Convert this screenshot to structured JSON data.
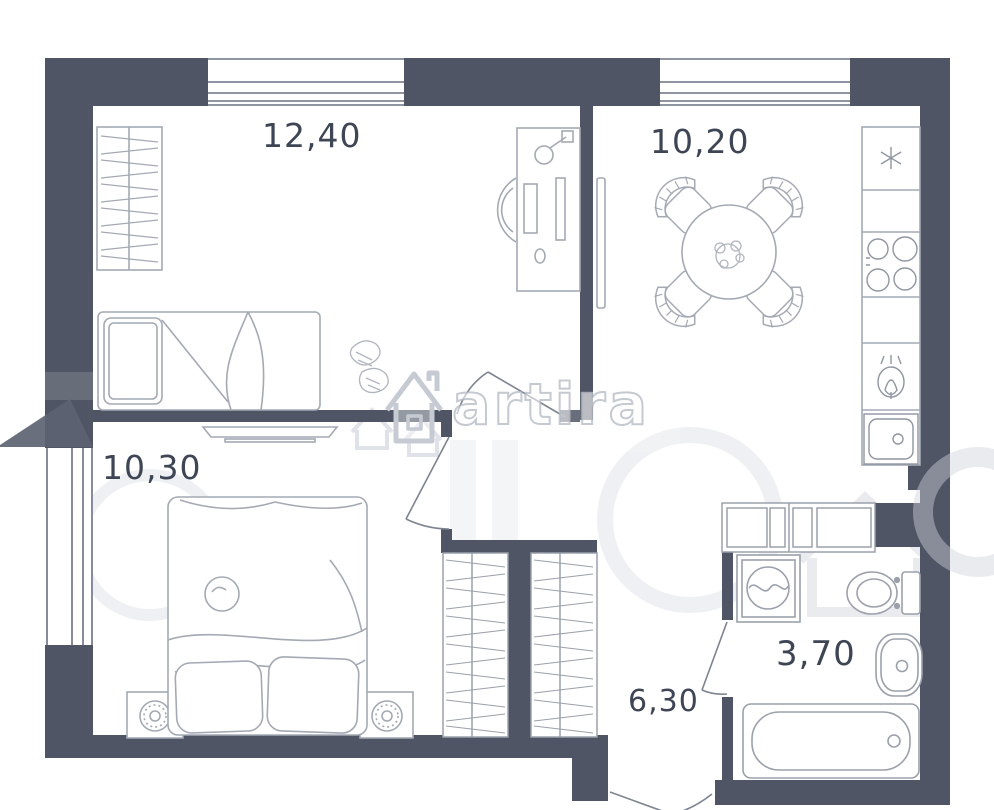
{
  "plan": {
    "type": "apartment-floor-plan",
    "rooms": [
      {
        "id": "bedroom-top",
        "name": "room with desk and single bed",
        "area_label": "12,40"
      },
      {
        "id": "kitchen",
        "name": "kitchen with dining table",
        "area_label": "10,20"
      },
      {
        "id": "bedroom-bottom",
        "name": "room with double bed",
        "area_label": "10,30"
      },
      {
        "id": "hallway",
        "name": "hallway with closets",
        "area_label": "6,30"
      },
      {
        "id": "bathroom",
        "name": "bathroom",
        "area_label": "3,70"
      }
    ],
    "furniture": [
      "wardrobe",
      "single-bed",
      "skates-decor",
      "desk",
      "desk-chair",
      "desk-lamp",
      "computer-monitor",
      "keyboard",
      "tv-kitchen",
      "dining-table",
      "dining-chairs",
      "flower-centerpiece",
      "fridge",
      "stove",
      "kitchen-faucet",
      "kitchen-sink",
      "tv-stand",
      "double-bed",
      "nightstand-lamps",
      "closet-left",
      "closet-right",
      "entry-cabinets",
      "washing-machine",
      "toilet",
      "bathroom-sink",
      "bathtub"
    ],
    "watermark": {
      "text": "artira",
      "logo": "house-icon"
    },
    "colors": {
      "wall": "#4f5564",
      "furniture_line": "#a4a9b4",
      "appliance_line": "#8f95a1",
      "window_line": "#6a7080",
      "label_text": "#3e4554",
      "watermark_dark": "#5d6373",
      "watermark_light": "#eef0f3"
    }
  }
}
